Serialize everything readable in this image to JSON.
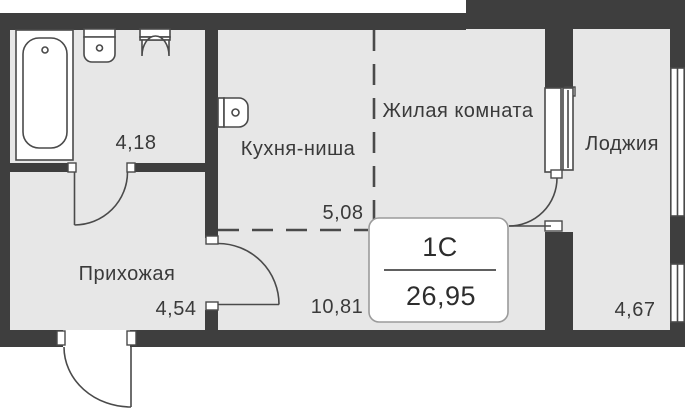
{
  "plan": {
    "badge": {
      "unit_type": "1С",
      "total_area": "26,95"
    },
    "rooms": [
      {
        "id": "bathroom",
        "area": "4,18"
      },
      {
        "id": "kitchen-niche",
        "label": "Кухня-ниша",
        "area": "5,08"
      },
      {
        "id": "living-room",
        "label": "Жилая комната",
        "area": "10,81"
      },
      {
        "id": "hallway",
        "label": "Прихожая",
        "area": "4,54"
      },
      {
        "id": "loggia",
        "label": "Лоджия",
        "area": "4,67"
      }
    ],
    "icons": {
      "bathtub": "bathtub-icon",
      "bathroom_sink": "sink-icon",
      "toilet": "toilet-icon",
      "kitchen_sink": "kitchen-sink-icon"
    },
    "colors": {
      "wall": "#3e3e3e",
      "room_fill": "#e7e7e7",
      "line": "#4a4a4a",
      "text": "#3a3a3a",
      "badge_border": "#9b9b9b"
    }
  }
}
